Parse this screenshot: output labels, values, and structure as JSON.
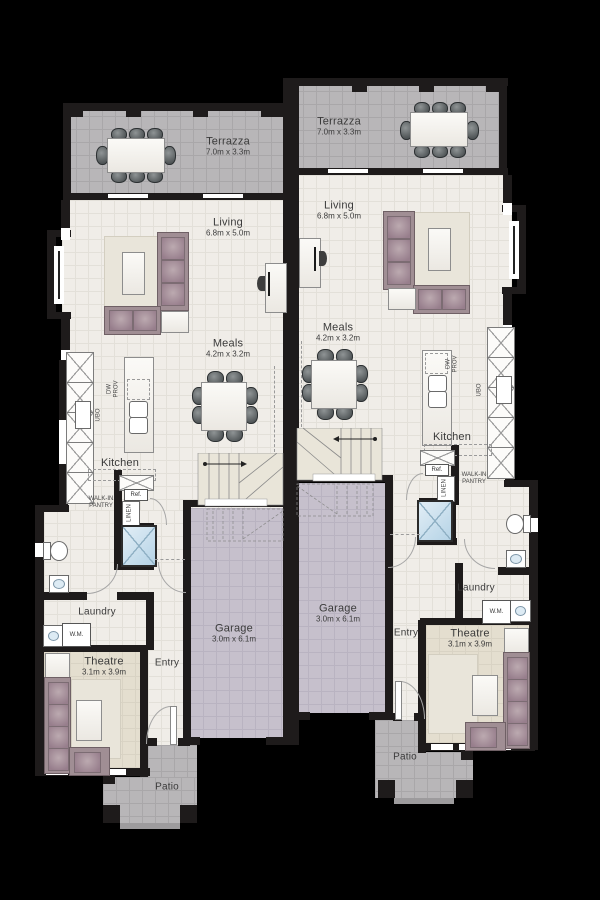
{
  "plan": {
    "colors": {
      "background": "#000000",
      "wall": "#1e1b1b",
      "terrace_floor": "#b8b6b8",
      "interior_floor": "#f0ede8",
      "theatre_floor": "#e4decf",
      "garage_floor": "#c6c0cc",
      "sofa": "#a08e94",
      "shower": "#b5d3e6"
    },
    "units": {
      "left": {
        "terrazza": {
          "label": "Terrazza",
          "dims": "7.0m x 3.3m"
        },
        "living": {
          "label": "Living",
          "dims": "6.8m x 5.0m"
        },
        "meals": {
          "label": "Meals",
          "dims": "4.2m x 3.2m"
        },
        "kitchen": {
          "label": "Kitchen"
        },
        "pantry": {
          "label": "WALK-IN PANTRY"
        },
        "fridge": {
          "label": "Ref."
        },
        "linen": {
          "label": "LINEN"
        },
        "laundry": {
          "label": "Laundry"
        },
        "wm": {
          "label": "W.M."
        },
        "theatre": {
          "label": "Theatre",
          "dims": "3.1m x 3.9m"
        },
        "entry": {
          "label": "Entry"
        },
        "garage": {
          "label": "Garage",
          "dims": "3.0m x 6.1m"
        },
        "patio": {
          "label": "Patio"
        },
        "ubo": {
          "label": "UBO"
        },
        "dw": {
          "label": "DW PROV"
        }
      },
      "right": {
        "terrazza": {
          "label": "Terrazza",
          "dims": "7.0m x 3.3m"
        },
        "living": {
          "label": "Living",
          "dims": "6.8m x 5.0m"
        },
        "meals": {
          "label": "Meals",
          "dims": "4.2m x 3.2m"
        },
        "kitchen": {
          "label": "Kitchen"
        },
        "pantry": {
          "label": "WALK-IN PANTRY"
        },
        "fridge": {
          "label": "Ref."
        },
        "linen": {
          "label": "LINEN"
        },
        "laundry": {
          "label": "Laundry"
        },
        "wm": {
          "label": "W.M."
        },
        "theatre": {
          "label": "Theatre",
          "dims": "3.1m x 3.9m"
        },
        "entry": {
          "label": "Entry"
        },
        "garage": {
          "label": "Garage",
          "dims": "3.0m x 6.1m"
        },
        "patio": {
          "label": "Patio"
        },
        "ubo": {
          "label": "UBO"
        },
        "dw": {
          "label": "DW PROV"
        }
      }
    }
  }
}
